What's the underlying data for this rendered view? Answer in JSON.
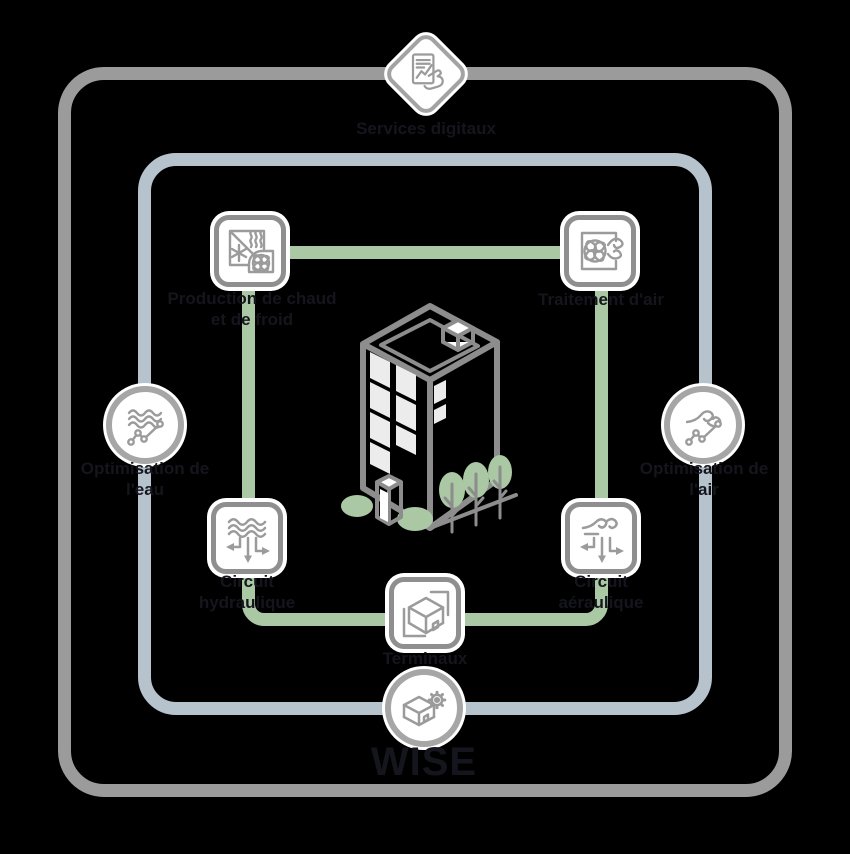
{
  "colors": {
    "background": "#000000",
    "outer_ring": "#9b9b9b",
    "digital_ring": "#b6c2cc",
    "system_ring": "#a9c8a3",
    "icon_border": "#8f8f8f",
    "glyph": "#9b9b9b",
    "ink": "#15151e",
    "window": "#ececec",
    "building_outline": "#8d8d8d",
    "greenery": "#a9c8a3"
  },
  "nodes": {
    "services": {
      "label": "Services digitaux"
    },
    "production": {
      "line1": "Production de chaud",
      "line2": "et de froid"
    },
    "traitement": {
      "label": "Traitement d'air"
    },
    "opt_eau": {
      "line1": "Optimisation de",
      "line2": "l'eau"
    },
    "opt_air": {
      "line1": "Optimisation de",
      "line2": "l'air"
    },
    "hydraulique": {
      "line1": "Circuit",
      "line2": "hydraulique"
    },
    "aeraulique": {
      "line1": "Circuit",
      "line2": "aéraulique"
    },
    "terminaux": {
      "label": "Terminaux"
    },
    "wise": {
      "label": "WISE"
    }
  }
}
